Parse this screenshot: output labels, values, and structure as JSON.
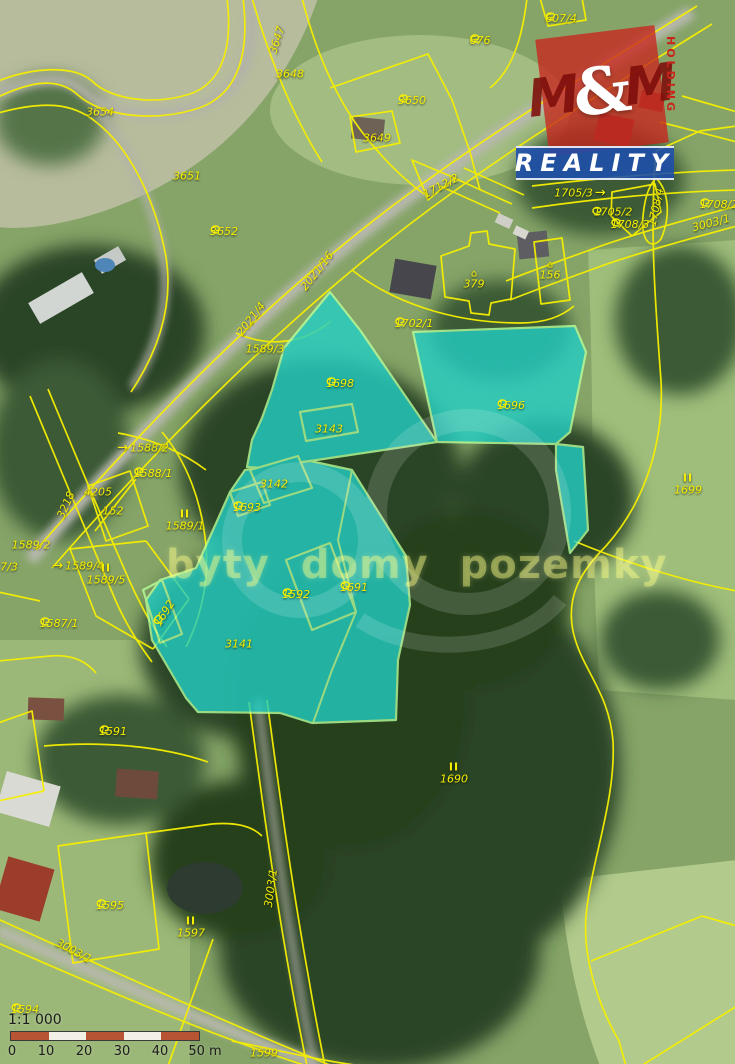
{
  "map_overlay": {
    "watermark_text": "byty domy pozemky",
    "logo": {
      "m_left": "M",
      "ampersand": "&",
      "m_right": "M",
      "banner": "REALITY",
      "holding": "HOLDING"
    },
    "scale_bar": {
      "ratio": "1:1 000",
      "ticks": [
        "0",
        "10",
        "20",
        "30",
        "40",
        "50 m"
      ]
    },
    "colors": {
      "highlight_fill": "#23cfc5",
      "highlight_border": "#b8ff9c",
      "cadastral_line": "#f6ef00",
      "scalebar_segment": "#b65433",
      "logo_red": "#c8251d",
      "logo_blue": "#1e4fae"
    },
    "highlighted_parcel_ids": [
      "1698",
      "1696",
      "3143",
      "3142",
      "1693",
      "1692",
      "1592",
      "1691",
      "3141"
    ],
    "parcel_labels": [
      {
        "text": "3647",
        "x": 277,
        "y": 40,
        "rot": -72
      },
      {
        "text": "3648",
        "x": 290,
        "y": 74
      },
      {
        "text": "3654",
        "x": 100,
        "y": 112
      },
      {
        "text": "3651",
        "x": 187,
        "y": 176
      },
      {
        "text": "3650",
        "x": 412,
        "y": 100,
        "icon": "curl"
      },
      {
        "text": "3649",
        "x": 377,
        "y": 138
      },
      {
        "text": "3652",
        "x": 224,
        "y": 231,
        "icon": "curl"
      },
      {
        "text": "607/4",
        "x": 561,
        "y": 18,
        "icon": "curl"
      },
      {
        "text": "676",
        "x": 480,
        "y": 40,
        "icon": "curl"
      },
      {
        "text": "1712/2",
        "x": 441,
        "y": 186,
        "rot": -28
      },
      {
        "text": "1705/3",
        "x": 580,
        "y": 193,
        "arrow": "after"
      },
      {
        "text": "1705/2",
        "x": 612,
        "y": 212,
        "icon": "curl",
        "iconpos": "left"
      },
      {
        "text": "1708/4",
        "x": 656,
        "y": 207,
        "rot": -78
      },
      {
        "text": "1708/3",
        "x": 630,
        "y": 224,
        "icon": "curl"
      },
      {
        "text": "1708/2",
        "x": 719,
        "y": 204,
        "icon": "curl"
      },
      {
        "text": "3003/1",
        "x": 711,
        "y": 223,
        "rot": -15
      },
      {
        "text": "156",
        "x": 550,
        "y": 271,
        "icon": "house"
      },
      {
        "text": "379",
        "x": 474,
        "y": 280,
        "icon": "house"
      },
      {
        "text": "1702/1",
        "x": 414,
        "y": 323,
        "icon": "curl"
      },
      {
        "text": "2021/16",
        "x": 317,
        "y": 271,
        "rot": -52
      },
      {
        "text": "2021/4",
        "x": 251,
        "y": 319,
        "rot": -52
      },
      {
        "text": "1589/3",
        "x": 265,
        "y": 349
      },
      {
        "text": "1588/2",
        "x": 143,
        "y": 448,
        "arrow": "before"
      },
      {
        "text": "1588/1",
        "x": 153,
        "y": 473,
        "icon": "curl"
      },
      {
        "text": "4205",
        "x": 98,
        "y": 492
      },
      {
        "text": "152",
        "x": 113,
        "y": 511
      },
      {
        "text": "1589/1",
        "x": 185,
        "y": 520,
        "sub": "II"
      },
      {
        "text": "3218",
        "x": 66,
        "y": 505,
        "rot": -66
      },
      {
        "text": "1589/2",
        "x": 31,
        "y": 545
      },
      {
        "text": "1589/4",
        "x": 78,
        "y": 566,
        "arrow": "before"
      },
      {
        "text": "1589/5",
        "x": 106,
        "y": 574,
        "sub": "II"
      },
      {
        "text": "7/3",
        "x": 9,
        "y": 567
      },
      {
        "text": "1587/1",
        "x": 59,
        "y": 623,
        "icon": "curl"
      },
      {
        "text": "1698",
        "x": 340,
        "y": 383,
        "icon": "curl"
      },
      {
        "text": "3143",
        "x": 329,
        "y": 429
      },
      {
        "text": "1696",
        "x": 511,
        "y": 405,
        "icon": "curl"
      },
      {
        "text": "3142",
        "x": 274,
        "y": 484
      },
      {
        "text": "1693",
        "x": 247,
        "y": 507,
        "icon": "curl"
      },
      {
        "text": "1692",
        "x": 164,
        "y": 613,
        "rot": -58,
        "icon": "curl"
      },
      {
        "text": "1592",
        "x": 296,
        "y": 594,
        "icon": "curl"
      },
      {
        "text": "1691",
        "x": 354,
        "y": 587,
        "icon": "curl"
      },
      {
        "text": "3141",
        "x": 239,
        "y": 644
      },
      {
        "text": "1699",
        "x": 688,
        "y": 484,
        "sub": "II"
      },
      {
        "text": "1690",
        "x": 454,
        "y": 773,
        "sub": "II"
      },
      {
        "text": "1591",
        "x": 113,
        "y": 731,
        "icon": "curl"
      },
      {
        "text": "1595",
        "x": 110,
        "y": 905,
        "icon": "curl"
      },
      {
        "text": "1597",
        "x": 191,
        "y": 927,
        "sub": "II"
      },
      {
        "text": "3003/1",
        "x": 271,
        "y": 888,
        "rot": -82
      },
      {
        "text": "3003/1",
        "x": 74,
        "y": 951,
        "rot": 28
      },
      {
        "text": "1594",
        "x": 25,
        "y": 1009,
        "icon": "curl"
      },
      {
        "text": "1599",
        "x": 264,
        "y": 1053
      }
    ]
  }
}
